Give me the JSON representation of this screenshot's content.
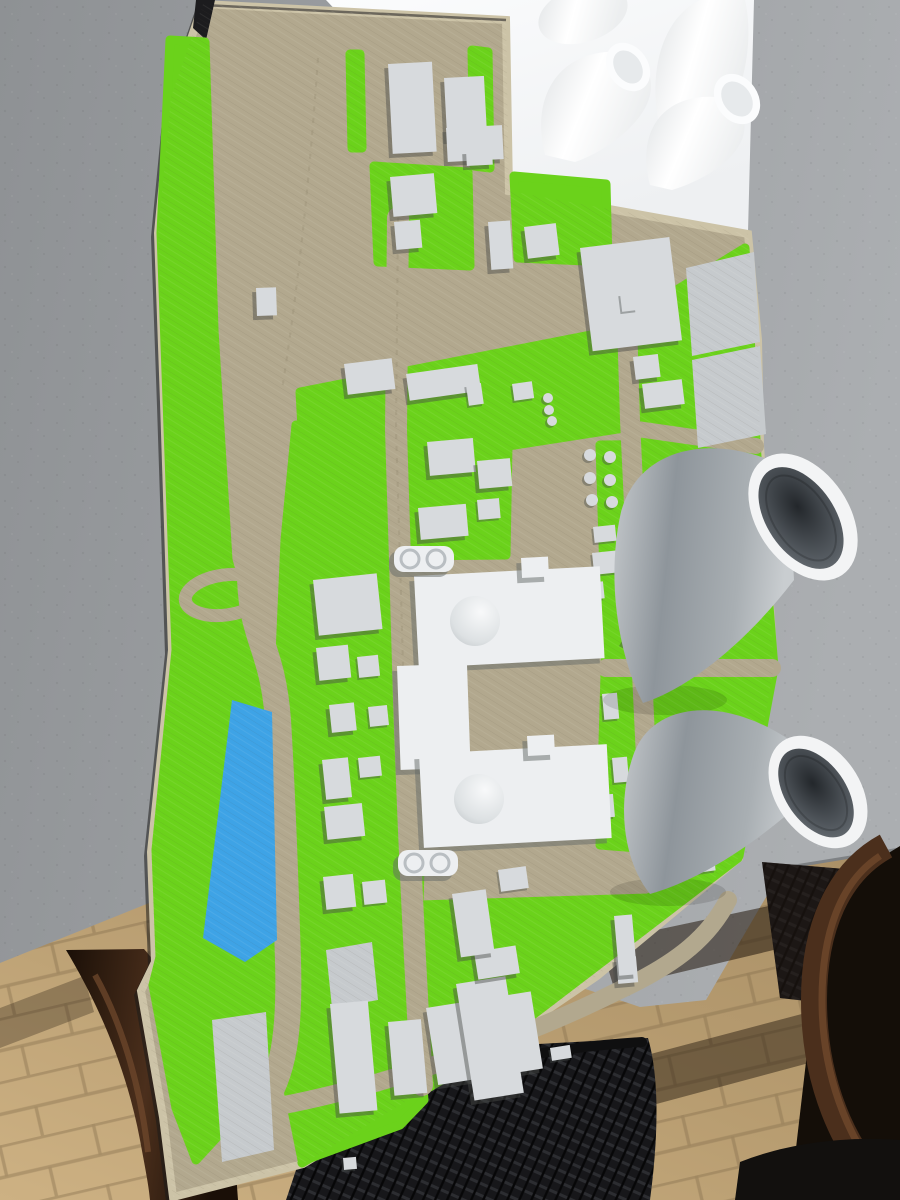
{
  "scene": {
    "description": "High-angle photograph of a 3D-printed architectural model of a nuclear power plant site lying on a gray outdoor table. The colored site model has a tan base with streets, bright green grass zones, a blue pond, dozens of small gray buildings, two domed reactor units and two large gray cooling towers with white rims. A separate all-white print with four small cooling towers on a white plate sits at the top. Below the table edge, tan paving slabs, a dark brown wooden chair frame and a black mesh chair seat are visible."
  },
  "colors": {
    "table_light": "#abaeb1",
    "table_mid": "#9b9ea1",
    "table_dark": "#8e9194",
    "plate_white": "#fbfcfd",
    "plate_shade": "#eef0f2",
    "gap_dark": "#191a1c",
    "model_tan": "#b2a88e",
    "model_curb": "#ccc3a7",
    "road_centerline": "#9d937a",
    "grass": "#6bd21b",
    "pond_blue": "#3ea3e6",
    "building_gray": "#d7dadd",
    "reactor_white": "#edeff1",
    "pad_gray": "#c6cacd",
    "tower_light": "#c5c9cc",
    "tower_mid": "#8e959b",
    "tower_rim": "#f3f4f5",
    "tower_inner_dark": "#23272b",
    "tower_inner_mid": "#565c62",
    "paver_light": "#cdb183",
    "paver_mid": "#b79c70",
    "paver_grout": "#846e4c",
    "shadow_brown": "rgba(34,24,13,0.55)",
    "mesh_dark": "#17171a",
    "mesh_line": "#2c2d31",
    "wood_dark": "#1a0f07",
    "wood_mid": "#4b2f1c",
    "wood_light": "#6f482c"
  },
  "site_model": {
    "kind": "3d-printed nuclear power plant site model",
    "base": "tan plate with printed street grid",
    "grass_zones": "bright green",
    "pond_count": 1,
    "small_gray_buildings": 40,
    "parking_pads": 4,
    "reactor_units": [
      {
        "name": "unit-1",
        "features": [
          "containment dome",
          "turbine hall",
          "twin round tanks"
        ]
      },
      {
        "name": "unit-2",
        "features": [
          "containment dome",
          "turbine hall",
          "twin round tanks"
        ]
      }
    ],
    "gray_cooling_towers": 2
  },
  "white_model": {
    "kind": "all-white 3d print",
    "cooling_towers": 4,
    "base": "white plate"
  },
  "surroundings": {
    "table": "gray concrete-look tabletop",
    "ground": "tan paving slabs with dark joints and long shadows",
    "chair_frame": "dark brown wood",
    "chair_seat": "black mesh"
  }
}
